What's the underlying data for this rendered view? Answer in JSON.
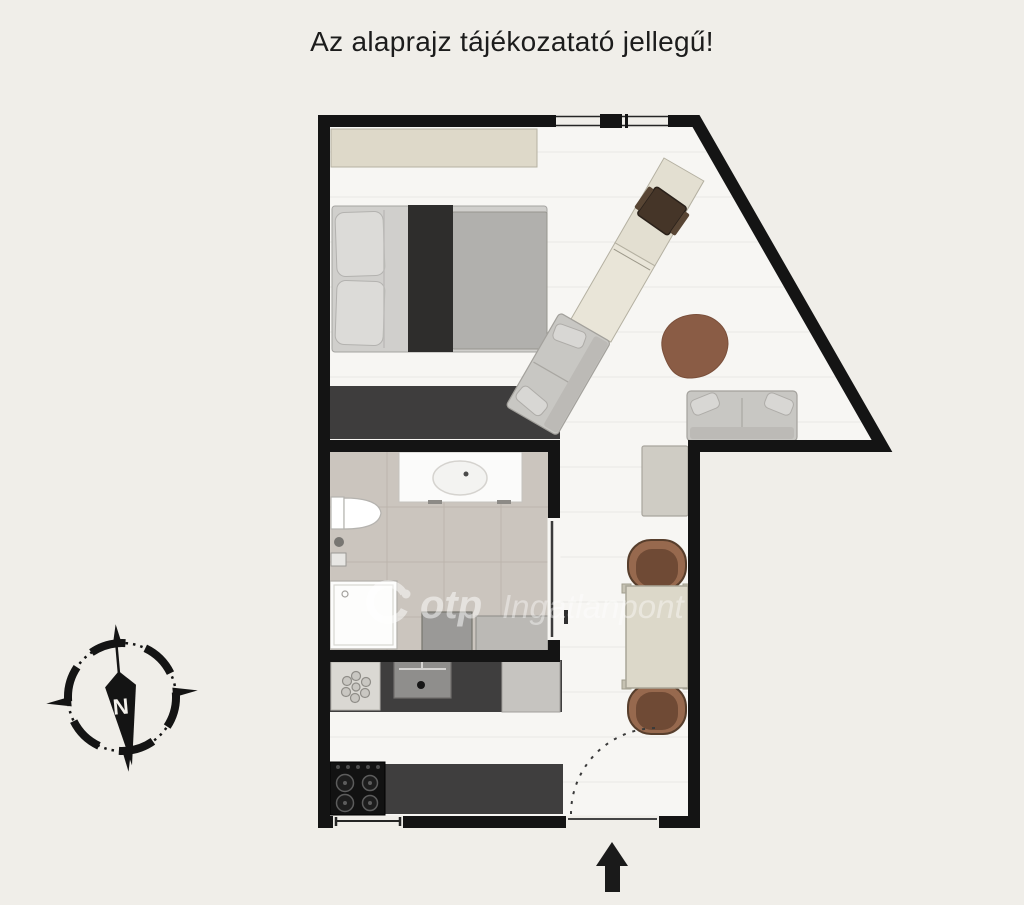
{
  "title": "Az alaprajz tájékozatató jellegű!",
  "watermark": {
    "brand": "otp",
    "suffix": "Ingatlanpont"
  },
  "compass": {
    "north_label": "N"
  },
  "entrance": {
    "arrow_icon": "entrance-arrow-up-icon",
    "door_swing_icon": "door-swing-arc-icon"
  },
  "colors": {
    "background": "#f0eee9",
    "wall": "#141414",
    "floor": "#f7f6f3",
    "bathroom_floor": "#cbc5be",
    "built_in_dark": "#3e3d3d",
    "wood_beige": "#ded9c9",
    "sofa_gray": "#c8c7c3",
    "rug_brown": "#8a5c45",
    "dining_chair_brown": "#97694e",
    "watermark_white": "#ffffff"
  },
  "furniture_icons": [
    "wardrobe-shelf-icon",
    "double-bed-icon",
    "desk-icon",
    "desk-chair-icon",
    "chaise-sofa-icon",
    "sofa-icon",
    "rug-icon",
    "hall-cabinet-icon",
    "dining-table-icon",
    "dining-chair-icon",
    "washbasin-icon",
    "toilet-icon",
    "shower-icon",
    "washing-machine-icon",
    "kitchen-sink-icon",
    "stove-icon",
    "fridge-icon",
    "window-icon",
    "compass-icon"
  ]
}
